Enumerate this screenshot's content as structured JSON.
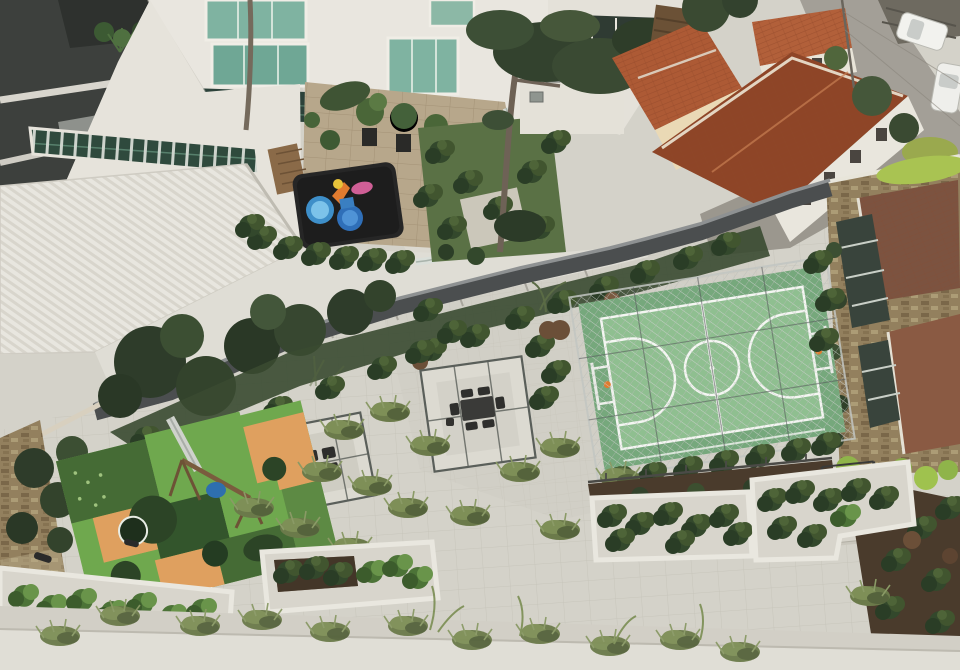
{
  "meta": {
    "description": "Aerial drone photograph of a condominium rooftop amenity garden beside apartment towers and tile-roofed houses",
    "scene_type": "aerial-photograph",
    "visible_text": ""
  },
  "palette": {
    "white_building": "#e9e6df",
    "white_shadow": "#d9d6cd",
    "dark_tower": "#3d403d",
    "glass_green": "#7fb3a1",
    "glazed_dark": "#2c423a",
    "roof_white": "#e8e6df",
    "skylight_green": "#2f4a3d",
    "terrace_paver": "#b7a78b",
    "playmat_black": "#262626",
    "toy_blue": "#3e8fc9",
    "toy_orange": "#e07b2f",
    "toy_pink": "#cf5f96",
    "garden_grass": "#5a7145",
    "tree_dark": "#33422e",
    "tree_mid": "#46573a",
    "shrub_dark": "#2f4029",
    "terracotta": "#ad5a35",
    "terracotta_dark": "#8e4527",
    "cream_wall": "#ead9b5",
    "street_gray": "#a39f97",
    "car_white": "#f2f2ee",
    "boundary_wall": "#4b4e4f",
    "wall_cap": "#8e9192",
    "stone_tan": "#93805e",
    "roof_brown": "#7c5340",
    "roof_brown2": "#8a5a43",
    "window_dark": "#39443c",
    "court_green": "#8fbf90",
    "court_apron": "#76a87c",
    "line_white": "#f4f6f2",
    "deck_paver": "#d4d2c9",
    "planter_white": "#e9e7df",
    "soil_dark": "#4a3b2c",
    "mulch_brown": "#6b4f38",
    "moss_green": "#a9c352",
    "play_bright": "#6fa84e",
    "play_mid": "#456b35",
    "play_dark": "#2c4426",
    "play_orange": "#dfa05f",
    "swing_blue": "#2e6fae",
    "bottom_wall": "#e0ded6"
  },
  "scene": {
    "sports_court": "green futsal court with white markings, basketball hoops and chain-link enclosure",
    "pergola_count": 2,
    "playground": "patchwork play surface in greens and orange with trampolines, slide and swing",
    "vehicle_count": 2,
    "boundary": "dark gray perimeter wall running diagonally",
    "houses": "terracotta tile roofs along street at top right"
  }
}
